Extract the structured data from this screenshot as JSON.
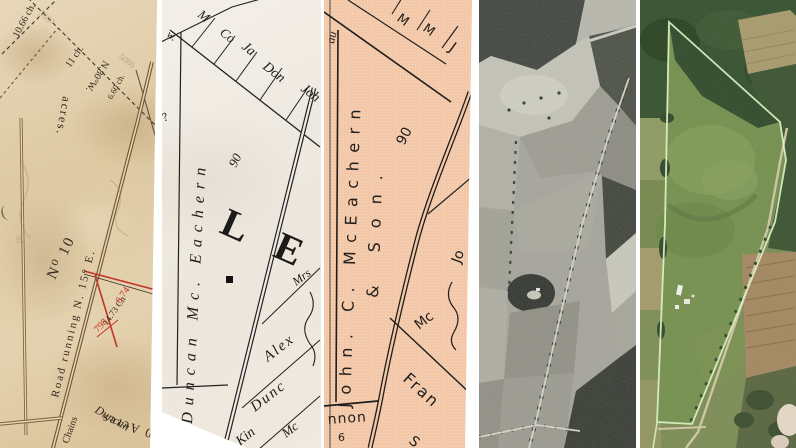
{
  "comparison": {
    "panel_count": 5
  },
  "panel1": {
    "description": "hand-drawn survey plat on aged paper",
    "paper_color": "#e6d5b2",
    "ink_color": "#33291e",
    "accent_red": "#c13527",
    "labels": {
      "ch_1066": "10.66 ch.",
      "ch_11": "11 ch.",
      "bearing_n80w": "N.80°W.",
      "ch_660": "6.60 ch.",
      "acres_word": "acres.",
      "lot_number": "N⁰ 10",
      "road_bearing": "Road running N. 15° E.",
      "ch_1473": "14.73 Ch",
      "red_674": "6.74",
      "red_798": "798",
      "chains": "Chains",
      "acres_0": "0 Acres",
      "owner_script": "Duncan",
      "bracket": "(",
      "pencil_1": "3337",
      "pencil_2": "5086",
      "pencil_3": "92"
    }
  },
  "panel2": {
    "description": "engraved black-and-white county map",
    "paper_color": "#f0ebe3",
    "labels": {
      "strip_m": "M",
      "strip_co": "Co",
      "strip_ja": "Ja",
      "strip_don": "Don",
      "strip_joh": "Joh",
      "frag_w": "w.",
      "frag_q": "?",
      "owner": "Duncan Mc. Eachern",
      "acreage": "90",
      "township_letters": "L E",
      "mrs": "Mrs",
      "alex": "Alex",
      "dunc": "Dunc",
      "mc": "Mc",
      "kin": "Kin"
    }
  },
  "panel3": {
    "description": "printed salmon-toned plat map",
    "paper_color": "#f2c8a8",
    "labels": {
      "owner_line1": "John. C. McEachern",
      "owner_line2": "& Son.",
      "acreage": "90",
      "strip_m1": "M",
      "strip_m2": "M",
      "strip_j": "J",
      "frag_jo": "Jo",
      "frag_au": "au",
      "mc": "Mc",
      "fran": "Fran",
      "s_frag": "S",
      "road_frag": "nnon",
      "number_6": "6"
    }
  },
  "panel4": {
    "description": "black-and-white aerial photograph of farmland"
  },
  "panel5": {
    "description": "color aerial photograph with outlined parcel",
    "boundary_color": "#dbf3c2"
  }
}
